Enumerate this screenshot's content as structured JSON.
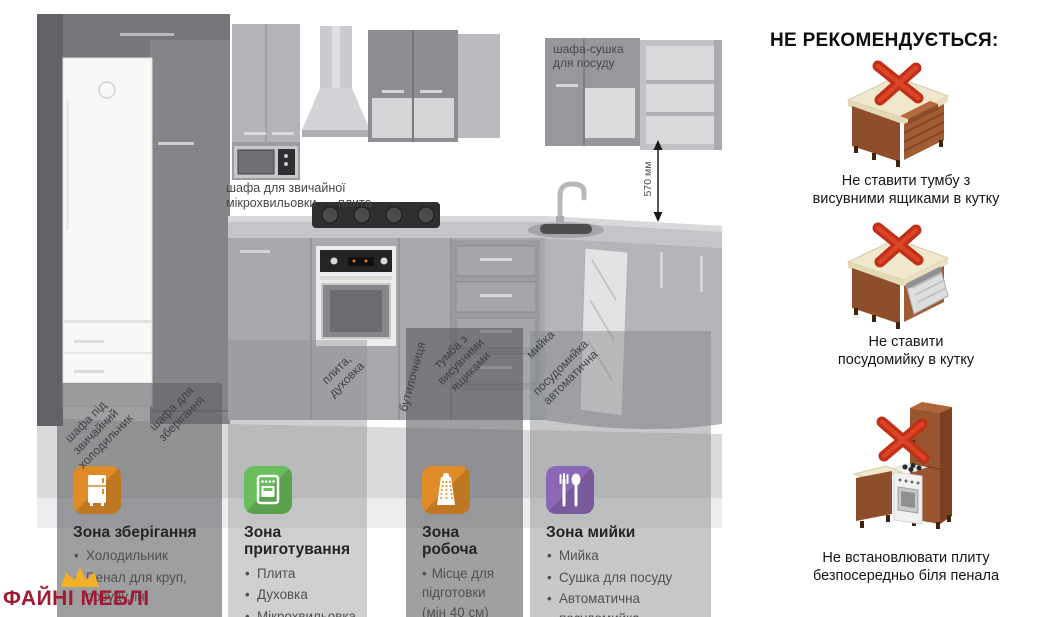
{
  "kitchen": {
    "labels": {
      "microwave_cabinet": "шафа для звичайної\nмікрохвильовки",
      "hob": "плита",
      "dryer_cabinet": "шафа-сушка\nдля посуду",
      "dimension": "570 мм"
    },
    "part_labels": [
      "шафа під\nзвичайний\nхолодильник",
      "шафа для\nзберігання",
      "плита,\nдуховка",
      "бутилочниця",
      "тумба з\nвисувними\nящиками",
      "мийка",
      "посудомийка\nавтоматична"
    ]
  },
  "zones": [
    {
      "title": "Зона зберігання",
      "icon": "fridge-icon",
      "color": "#DE8B28",
      "items": [
        "Холодильник",
        "Пенал для круп, посуду, ін."
      ]
    },
    {
      "title": "Зона приготування",
      "icon": "stove-icon",
      "color": "#69BD5B",
      "items": [
        "Плита",
        "Духовка",
        "Мікрохвильовка"
      ]
    },
    {
      "title": "Зона робоча",
      "icon": "grater-icon",
      "color": "#DE8B28",
      "items": [
        "Місце для підготовки (мін 40 см)"
      ]
    },
    {
      "title": "Зона мийки",
      "icon": "cutlery-icon",
      "color": "#8B68B6",
      "items": [
        "Мийка",
        "Сушка для посуду",
        "Автоматична посудомийка"
      ]
    }
  ],
  "not_recommended": {
    "title": "НЕ РЕКОМЕНДУЄТЬСЯ:",
    "items": [
      "Не ставити тумбу з\nвисувними ящиками в кутку",
      "Не ставити\nпосудомийку в кутку",
      "Не встановлювати плиту\nбезпосередньо біля пенала"
    ]
  },
  "logo": {
    "text": "ФАЙНІ МЕБЛІ",
    "color": "#A11A31"
  }
}
